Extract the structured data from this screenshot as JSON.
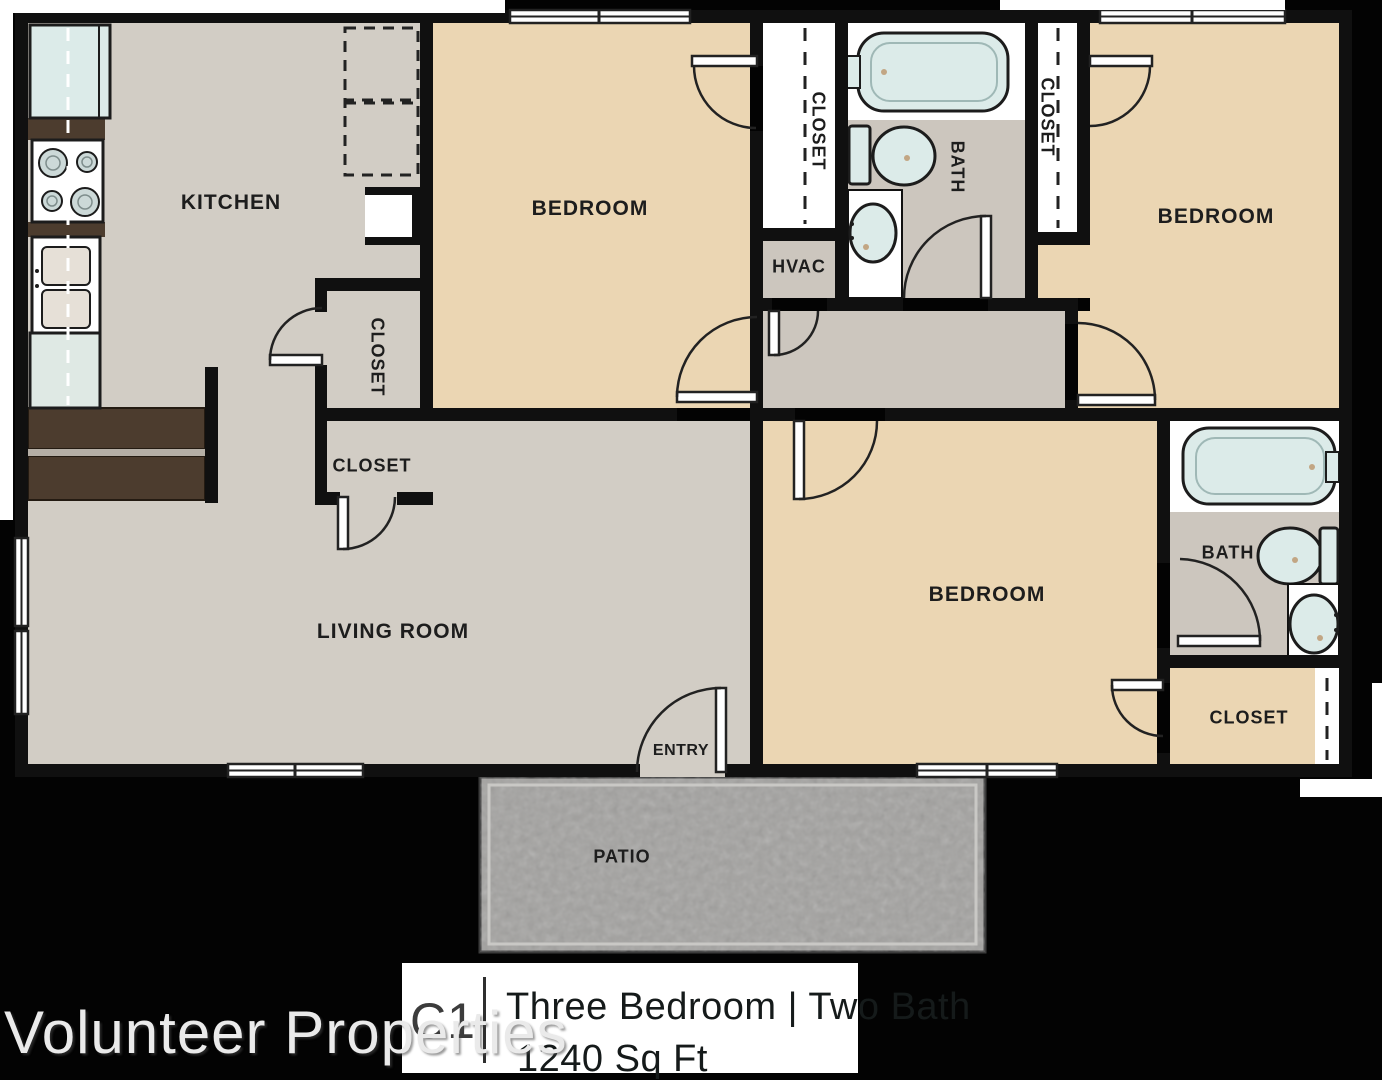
{
  "watermark": "Volunteer Properties",
  "footer": {
    "unit_code": "C1",
    "plan_title": "Three Bedroom  |  Two Bath",
    "area": "1240 Sq Ft"
  },
  "rooms": {
    "kitchen": "KITCHEN",
    "bedroom_top_left": "BEDROOM",
    "bedroom_top_right": "BEDROOM",
    "bedroom_bottom": "BEDROOM",
    "living_room": "LIVING ROOM",
    "bath_top": "BATH",
    "bath_bottom": "BATH",
    "hvac": "HVAC",
    "entry": "ENTRY",
    "patio": "PATIO",
    "closet_kitchen": "CLOSET",
    "closet_living": "CLOSET",
    "closet_bed_top_left": "CLOSET",
    "closet_bed_top_right": "CLOSET",
    "closet_bed_bottom": "CLOSET"
  },
  "colors": {
    "wall": "#101010",
    "floor_gray": "#d2cdc5",
    "floor_gray_dark": "#ccc6be",
    "floor_tan": "#ebd6b3",
    "counter_brown": "#4c3c2e",
    "fixture_blue": "#dcebe9",
    "patio_gray": "#a3a2a0"
  }
}
